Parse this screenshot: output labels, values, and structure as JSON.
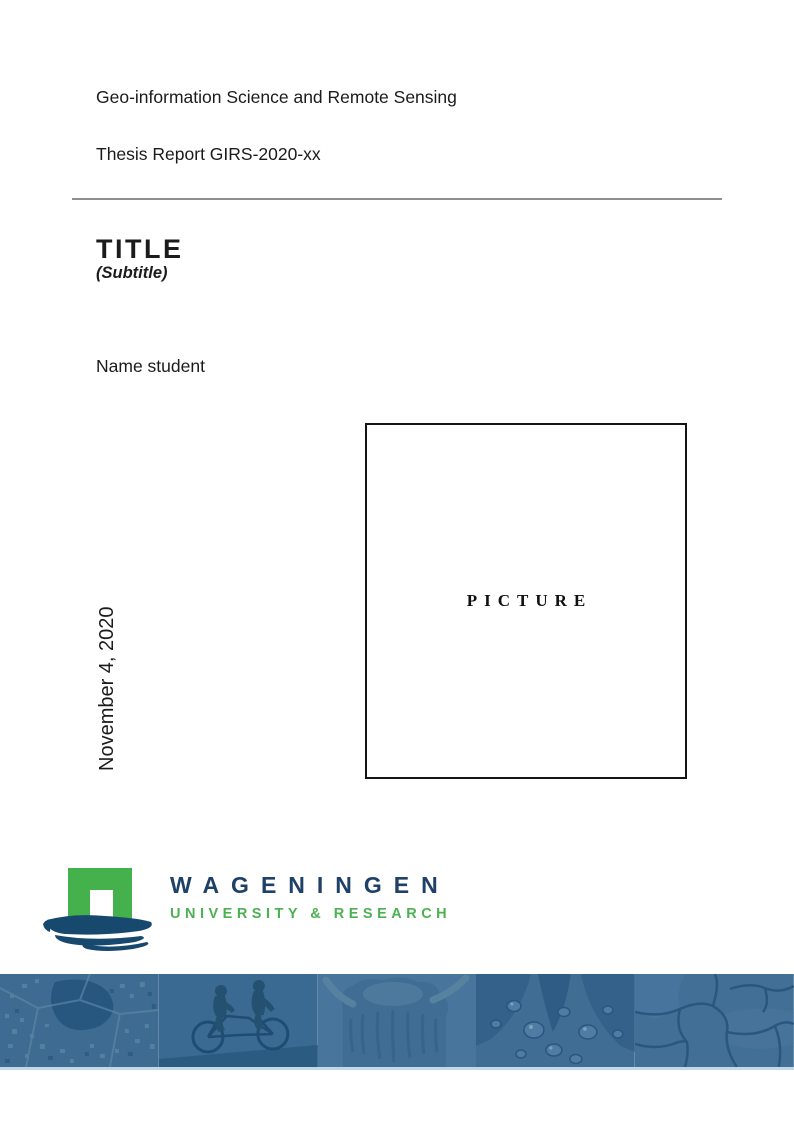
{
  "document": {
    "program": "Geo-information Science and Remote Sensing",
    "report_id": "Thesis Report GIRS-2020-xx",
    "title": "TITLE",
    "subtitle": "(Subtitle)",
    "author": "Name student",
    "date": "November 4, 2020",
    "picture_placeholder": "PICTURE"
  },
  "logo": {
    "wordmark": "WAGENINGEN",
    "tagline": "UNIVERSITY & RESEARCH",
    "icon": "wageningen-gate-icon",
    "colors": {
      "wordmark_navy": "#1E4167",
      "tagline_green": "#4CB152",
      "arch_green": "#45B14D",
      "brush_navy": "#17496E"
    }
  },
  "banner": {
    "tile_icons": [
      "aerial-map",
      "tandem-bicycle",
      "highland-cow",
      "water-droplets",
      "cracked-earth"
    ],
    "base_color": "#3E6B92",
    "hairline_color": "#BFD9E9"
  }
}
